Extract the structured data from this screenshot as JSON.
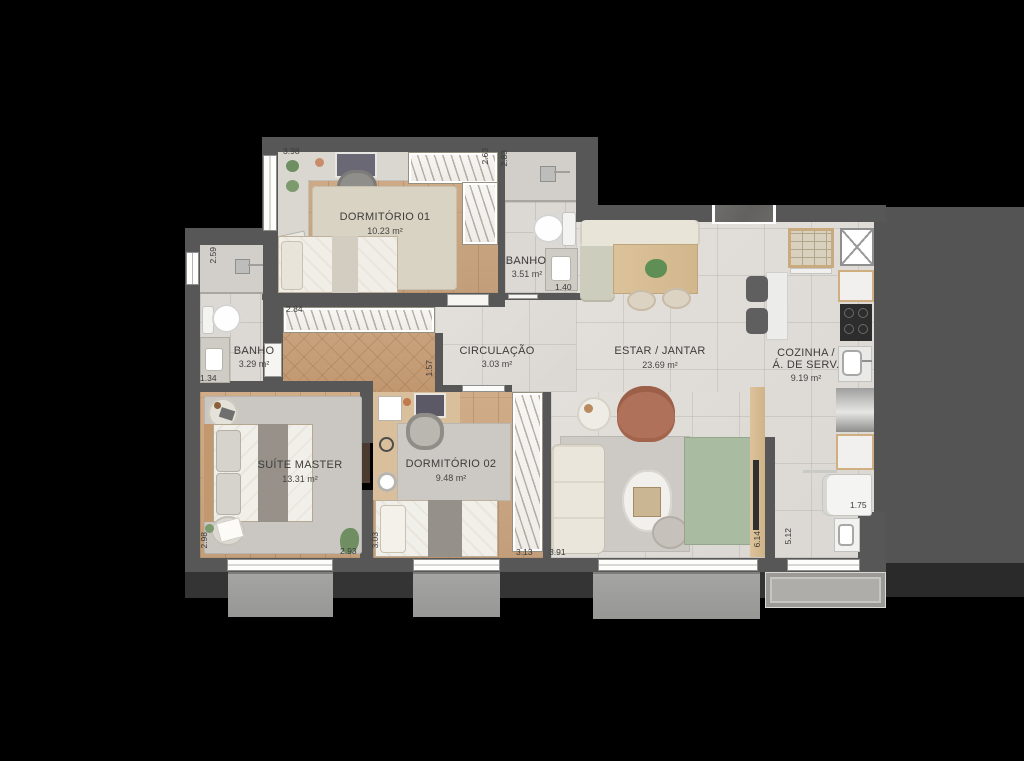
{
  "plan_title": "apartment-floor-plan",
  "rooms": {
    "dorm01": {
      "name": "DORMITÓRIO 01",
      "area": "10.23 m²"
    },
    "banho1": {
      "name": "BANHO",
      "area": "3.51 m²"
    },
    "banho2": {
      "name": "BANHO",
      "area": "3.29 m²"
    },
    "circulacao": {
      "name": "CIRCULAÇÃO",
      "area": "3.03 m²"
    },
    "estar": {
      "name": "ESTAR / JANTAR",
      "area": "23.69 m²"
    },
    "cozinha": {
      "name_line1": "COZINHA /",
      "name_line2": "Á. DE SERV.",
      "area": "9.19 m²"
    },
    "suite": {
      "name": "SUÍTE MASTER",
      "area": "13.31 m²"
    },
    "dorm02": {
      "name": "DORMITÓRIO 02",
      "area": "9.48 m²"
    }
  },
  "dimensions": {
    "dorm01_width": "3.98",
    "dorm01_depth": "2.63",
    "banho1_depth": "2.83",
    "banho1_width": "1.40",
    "banho2_depth": "2.59",
    "banho2_width": "1.34",
    "hall_closet_width": "2.84",
    "hall_depth": "1.57",
    "suite_depth": "2.98",
    "suite_width": "2.93",
    "dorm02_depth": "3.03",
    "dorm02_width": "3.13",
    "living_width": "3.91",
    "living_depth": "6.14",
    "kitchen_depth": "5.12",
    "service_width": "1.75"
  },
  "colors": {
    "background": "#000000",
    "wall": "#575757",
    "neighbor_mass": "#545455",
    "wood_floor": "#c9a37e",
    "tile_floor": "#dedbd7",
    "balcony": "#9c9c9b",
    "green_rug": "#a9bba1",
    "armchair": "#b0715a",
    "label_text": "#3d3c3a"
  }
}
